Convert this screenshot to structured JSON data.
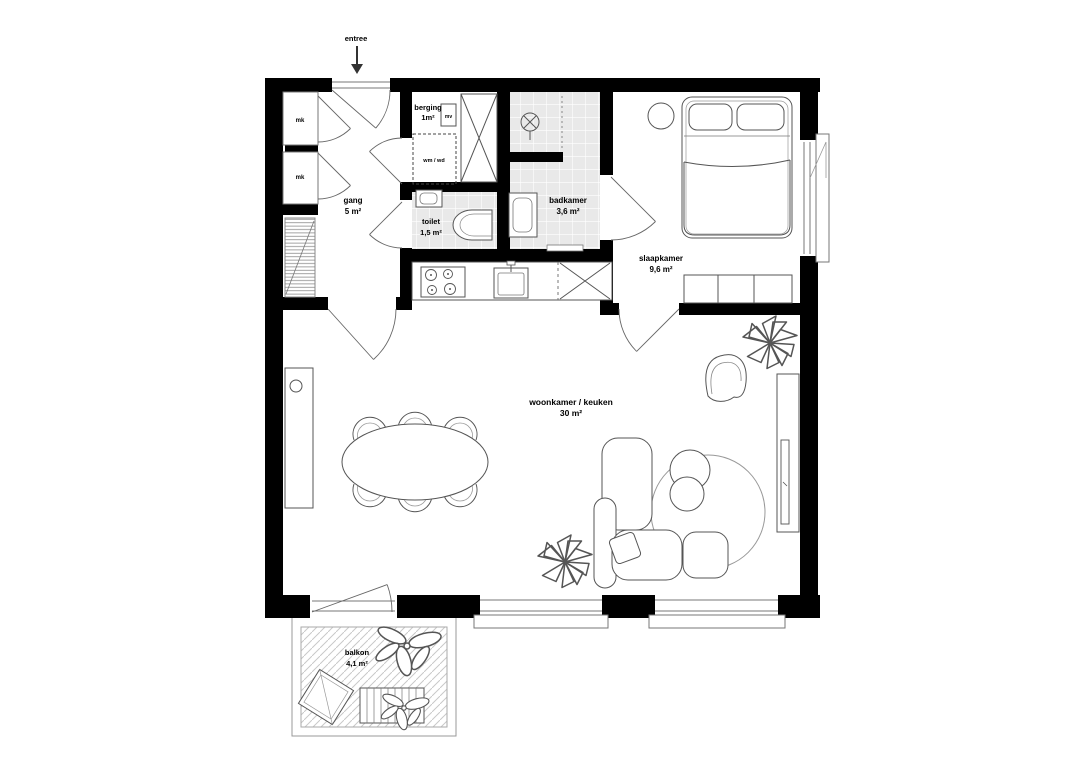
{
  "plan": {
    "entrance": {
      "label": "entree"
    },
    "rooms": [
      {
        "id": "gang",
        "name": "gang",
        "area": "5 m²"
      },
      {
        "id": "berging",
        "name": "berging",
        "area": "1m²"
      },
      {
        "id": "toilet",
        "name": "toilet",
        "area": "1,5 m²"
      },
      {
        "id": "badkamer",
        "name": "badkamer",
        "area": "3,6 m²"
      },
      {
        "id": "slaapkamer",
        "name": "slaapkamer",
        "area": "9,6 m²"
      },
      {
        "id": "woonkamer",
        "name": "woonkamer / keuken",
        "area": "30 m²"
      },
      {
        "id": "balkon",
        "name": "balkon",
        "area": "4,1 m²"
      }
    ],
    "small_labels": {
      "closet_top": "mk",
      "closet_bottom": "mk",
      "washer_dryer": "wm / wd",
      "vent_unit": "mv"
    },
    "colors": {
      "wall": "#000000",
      "line": "#555555",
      "tile_fill": "#e9e9e9",
      "hatch": "#c4c4c4",
      "background": "#ffffff"
    }
  }
}
